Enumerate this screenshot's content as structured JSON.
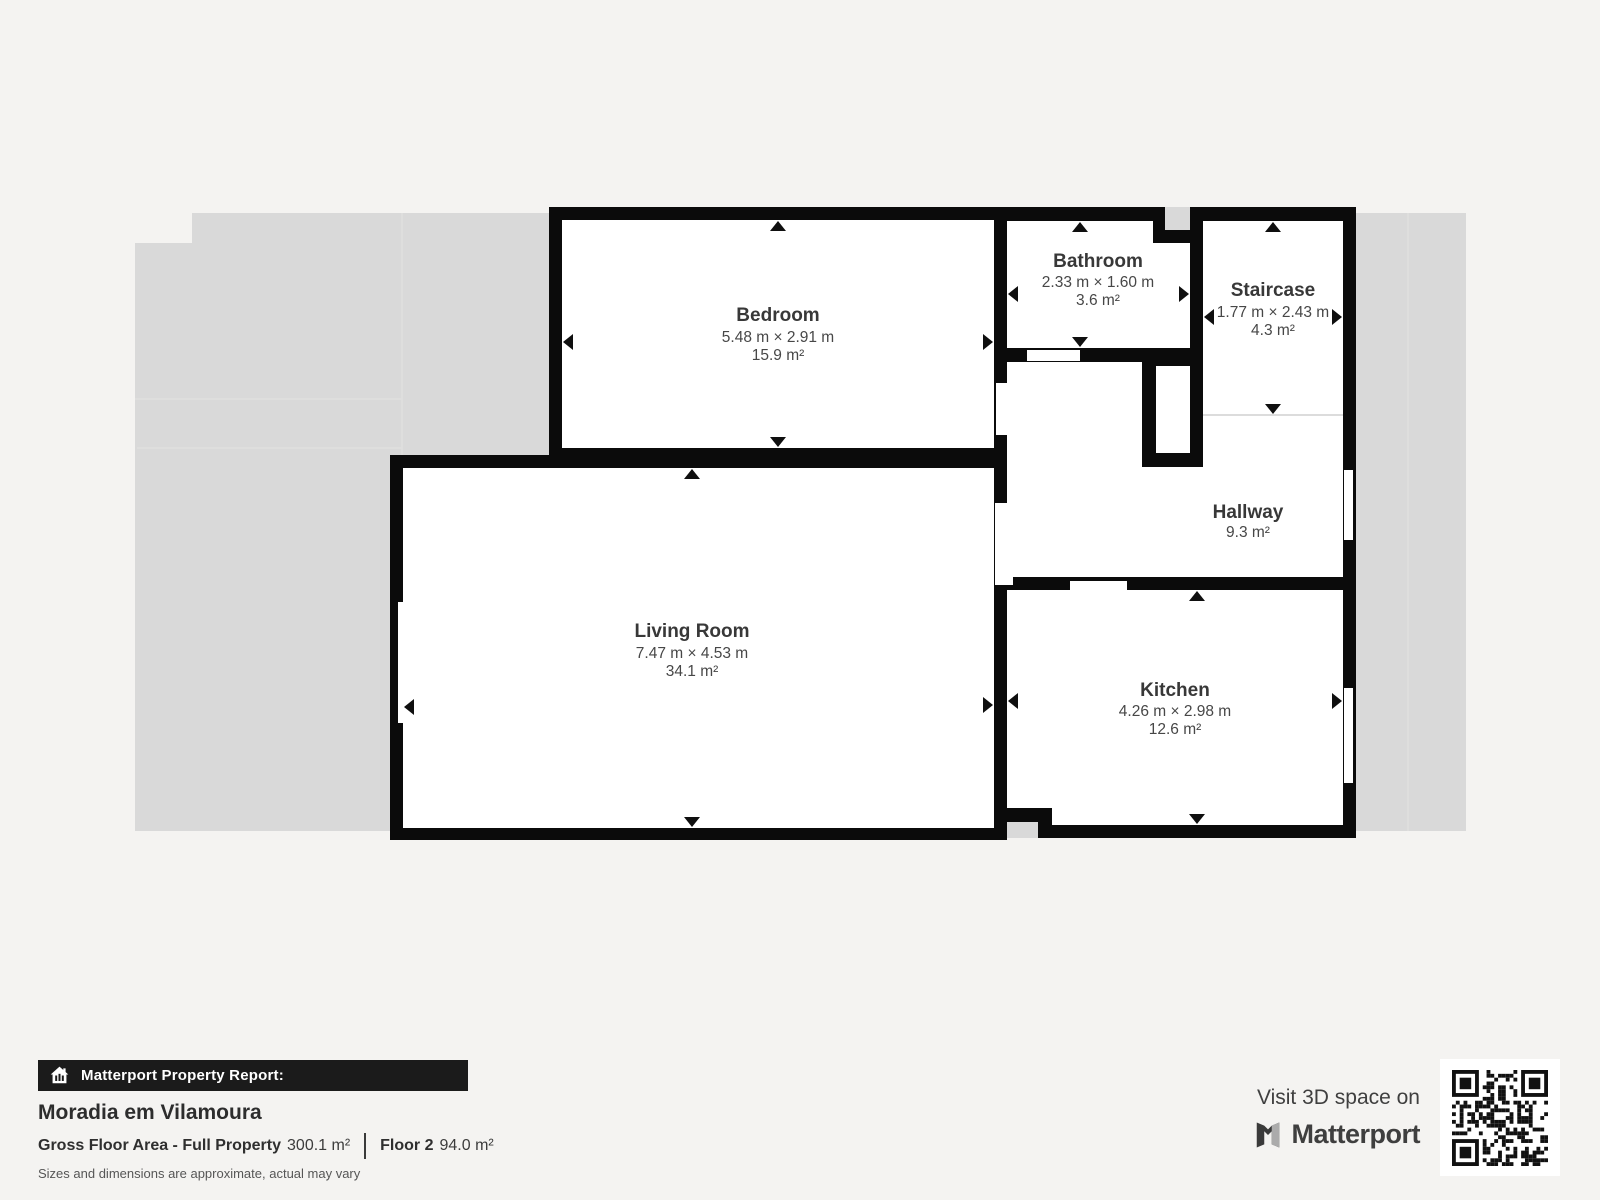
{
  "plan": {
    "rooms": {
      "bedroom": {
        "name": "Bedroom",
        "dimensions": "5.48 m × 2.91 m",
        "area": "15.9 m²"
      },
      "bathroom": {
        "name": "Bathroom",
        "dimensions": "2.33 m × 1.60 m",
        "area": "3.6 m²"
      },
      "staircase": {
        "name": "Staircase",
        "dimensions": "1.77 m × 2.43 m",
        "area": "4.3 m²"
      },
      "hallway": {
        "name": "Hallway",
        "area": "9.3 m²"
      },
      "living_room": {
        "name": "Living Room",
        "dimensions": "7.47 m × 4.53 m",
        "area": "34.1 m²"
      },
      "kitchen": {
        "name": "Kitchen",
        "dimensions": "4.26 m × 2.98 m",
        "area": "12.6 m²"
      }
    }
  },
  "footer": {
    "report_bar_label": "Matterport Property Report:",
    "property_name": "Moradia em Vilamoura",
    "gross_floor_area_label": "Gross Floor Area - Full Property",
    "gross_floor_area_value": "300.1 m²",
    "floor_label": "Floor 2",
    "floor_value": "94.0 m²",
    "disclaimer": "Sizes and dimensions are approximate, actual may vary"
  },
  "promo": {
    "visit_label": "Visit 3D space on",
    "brand_name": "Matterport"
  },
  "colors": {
    "wall": "#0b0b0b",
    "room_fill": "#ffffff",
    "backdrop_gray": "#d9d9d9",
    "page_background": "#f4f3f1",
    "room_label_text": "#383838",
    "report_bar_background": "#1b1b1b"
  }
}
